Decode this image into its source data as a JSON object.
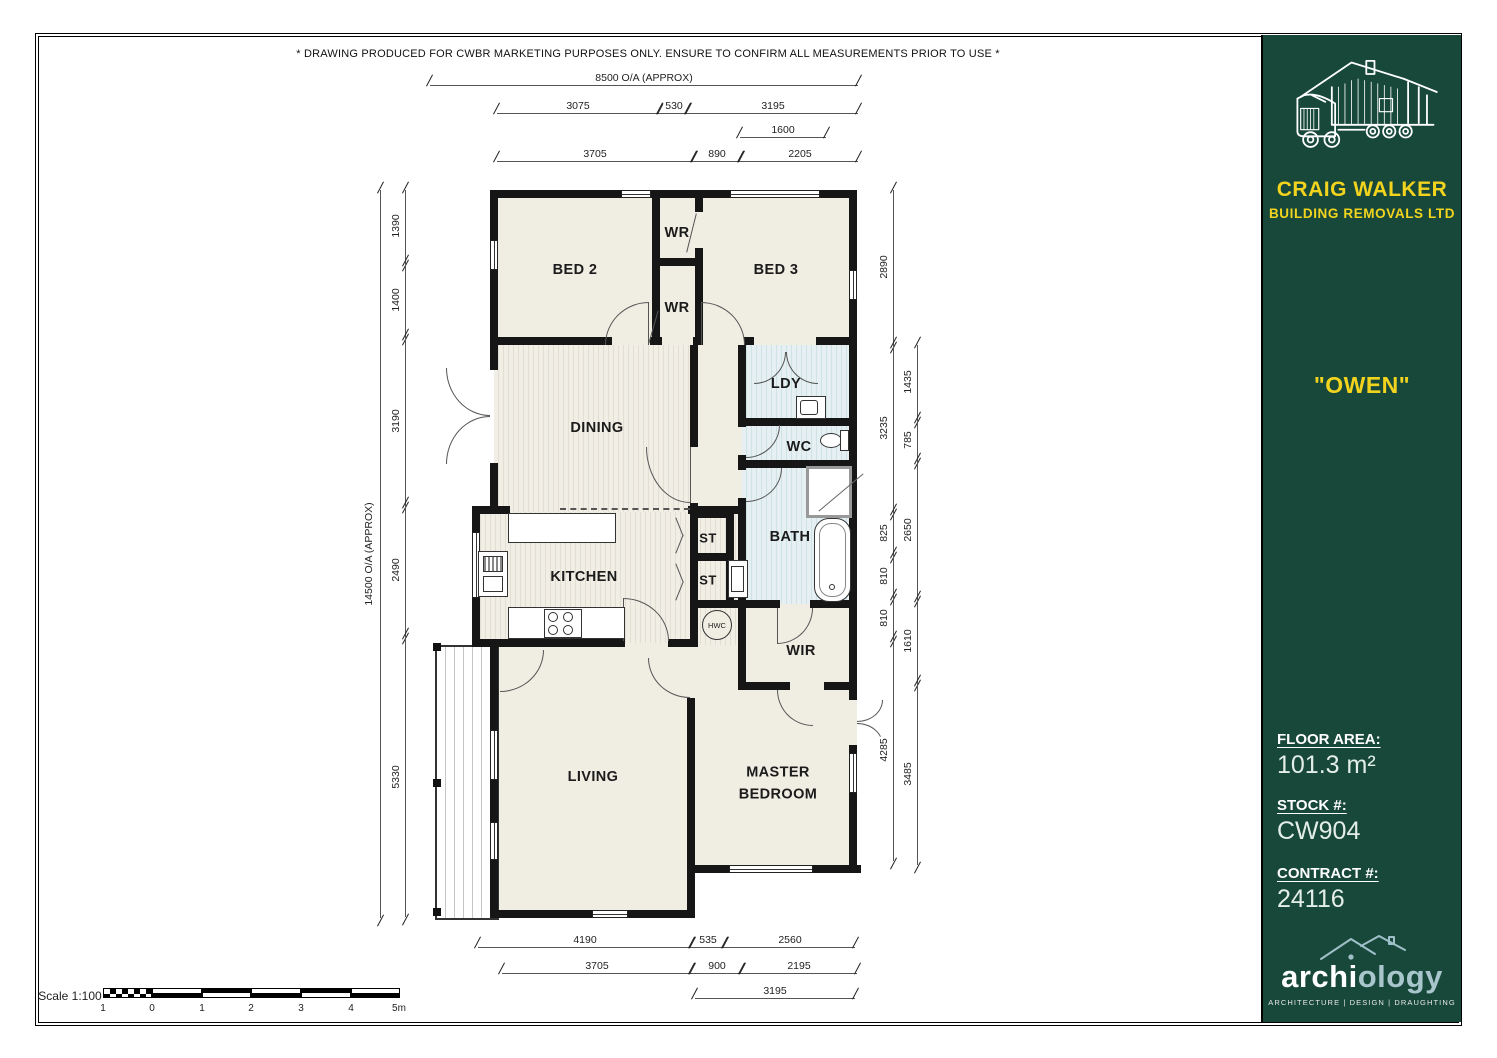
{
  "disclaimer": "* DRAWING PRODUCED FOR CWBR MARKETING PURPOSES ONLY. ENSURE TO CONFIRM ALL MEASUREMENTS PRIOR TO USE *",
  "rooms": {
    "bed2": "BED 2",
    "wr_top": "WR",
    "wr_bottom": "WR",
    "bed3": "BED 3",
    "dining": "DINING",
    "ldy": "LDY",
    "wc": "WC",
    "bath": "BATH",
    "st1": "ST",
    "st2": "ST",
    "kitchen": "KITCHEN",
    "hwc": "HWC",
    "wir": "WIR",
    "living": "LIVING",
    "master": "MASTER BEDROOM"
  },
  "dims": {
    "top_overall": "8500 O/A (APPROX)",
    "top": [
      "3075",
      "530",
      "3195",
      "1600",
      "3705",
      "890",
      "2205"
    ],
    "left_overall": "14500 O/A (APPROX)",
    "left": [
      "1390",
      "1400",
      "3190",
      "2490",
      "5330"
    ],
    "right_inner": [
      "2890",
      "3235",
      "825",
      "810",
      "810",
      "4285"
    ],
    "right_outer": [
      "1435",
      "785",
      "2650",
      "1610",
      "3485"
    ],
    "bottom": [
      "4190",
      "535",
      "2560",
      "3705",
      "900",
      "2195",
      "3195"
    ]
  },
  "scalebar": {
    "label": "Scale 1:100",
    "ticks": [
      "1",
      "0",
      "1",
      "2",
      "3",
      "4",
      "5m"
    ]
  },
  "sidebar": {
    "company_name": "CRAIG WALKER",
    "company_subtitle": "BUILDING REMOVALS LTD",
    "plan_name": "\"OWEN\"",
    "floor_area_label": "FLOOR AREA:",
    "floor_area_value": "101.3 m²",
    "stock_label": "STOCK #:",
    "stock_value": "CW904",
    "contract_label": "CONTRACT #:",
    "contract_value": "24116",
    "brand_left": "archi",
    "brand_right": "ology",
    "brand_tagline": "ARCHITECTURE | DESIGN | DRAUGHTING"
  }
}
